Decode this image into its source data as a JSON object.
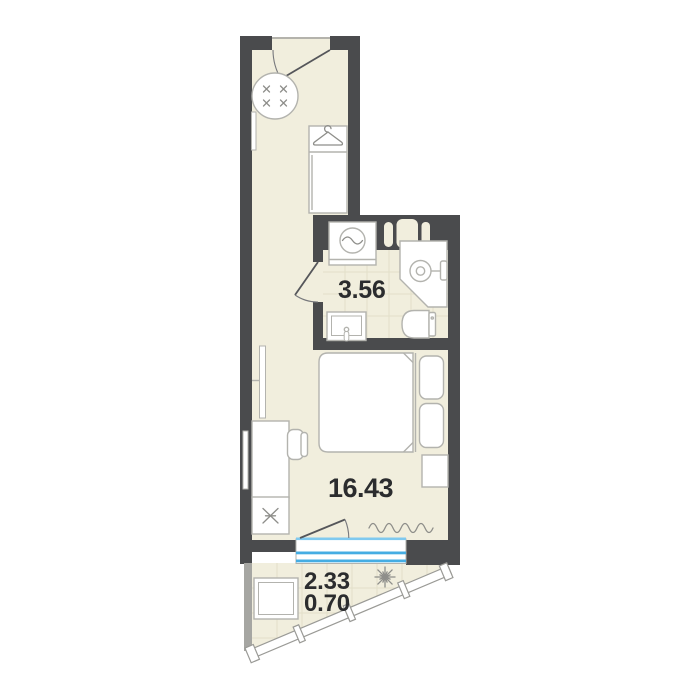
{
  "plan": {
    "title": "Studio apartment floor plan",
    "rooms": [
      {
        "id": "bathroom",
        "area": "3.56"
      },
      {
        "id": "living-room",
        "area": "16.43"
      },
      {
        "id": "balcony",
        "area_full": "2.33",
        "area_reduced": "0.70"
      }
    ],
    "colors": {
      "background": "#ffffff",
      "wall": "#4a4b4d",
      "floor": "#f1eedd",
      "tile_line": "#e2dfc9",
      "furniture_stroke": "#b3b3ae",
      "window_blue": "#45ade3",
      "window_blue_light": "#7fc9ef",
      "balcony_wall": "#a6a6a2",
      "label_text": "#2b2c2e"
    },
    "fixtures": [
      "entrance-door",
      "round-table",
      "hall-radiator",
      "wardrobe",
      "hanger-icon",
      "wall-niche-shelf",
      "washing-machine",
      "shower",
      "shower-drain",
      "toilet",
      "bathroom-sink",
      "bathroom-door",
      "tv",
      "desk",
      "chair",
      "kitchen-sink",
      "bed",
      "pillow",
      "nightstand",
      "curtain",
      "window",
      "balcony-door",
      "balcony-glazing",
      "balcony-table",
      "plant"
    ]
  }
}
